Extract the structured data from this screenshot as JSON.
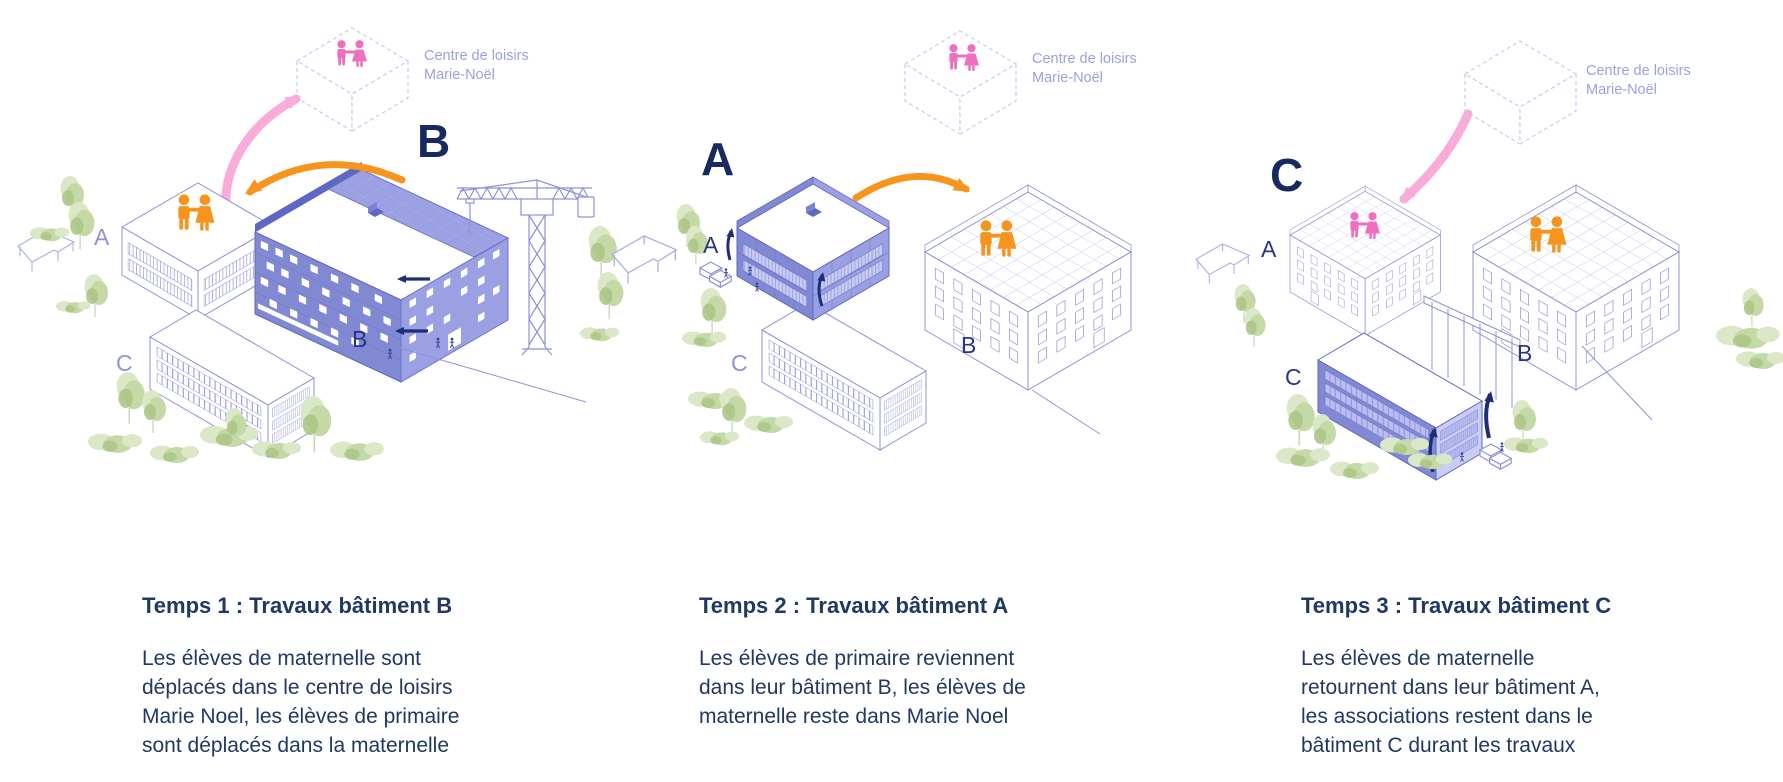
{
  "colors": {
    "text_navy": "#1F3864",
    "big_letter_navy": "#172A5E",
    "label_navy": "#27338C",
    "label_periwinkle": "#8D92DD",
    "building_outline": "#8E92DA",
    "building_fill_left": "#8289D3",
    "building_fill_right": "#9AA0E2",
    "orange": "#F7941E",
    "pink": "#F06EC0",
    "pink_arrow": "#F9ABD9",
    "tree_green": "#C5D9A6"
  },
  "icons": {
    "children": "children-pair-icon",
    "adults": "adults-pair-icon",
    "tree": "tree-icon",
    "bush": "bush-icon",
    "crane": "crane-icon",
    "bench": "bench-icon",
    "chair": "roof-chair-icon"
  },
  "panels": [
    {
      "big_letter": "B",
      "center": {
        "line1": "Centre de loisirs",
        "line2": "Marie-Noël"
      },
      "labels": {
        "a": "A",
        "b": "B",
        "c": "C"
      },
      "title": "Temps 1 : Travaux bâtiment B",
      "body_lines": [
        "Les élèves de maternelle sont",
        "déplacés dans le centre de loisirs",
        "Marie Noel, les élèves de primaire",
        "sont déplacés dans la maternelle"
      ]
    },
    {
      "big_letter": "A",
      "center": {
        "line1": "Centre de loisirs",
        "line2": "Marie-Noël"
      },
      "labels": {
        "a": "A",
        "b": "B",
        "c": "C"
      },
      "title": "Temps 2 : Travaux bâtiment A",
      "body_lines": [
        "Les élèves de primaire reviennent",
        "dans leur bâtiment B, les élèves de",
        "maternelle reste dans Marie Noel"
      ]
    },
    {
      "big_letter": "C",
      "center": {
        "line1": "Centre de loisirs",
        "line2": "Marie-Noël"
      },
      "labels": {
        "a": "A",
        "b": "B",
        "c": "C"
      },
      "title": "Temps 3 : Travaux bâtiment C",
      "body_lines": [
        "Les élèves de maternelle",
        "retournent dans leur bâtiment A,",
        "les associations restent dans le",
        "bâtiment C durant les travaux"
      ]
    }
  ]
}
